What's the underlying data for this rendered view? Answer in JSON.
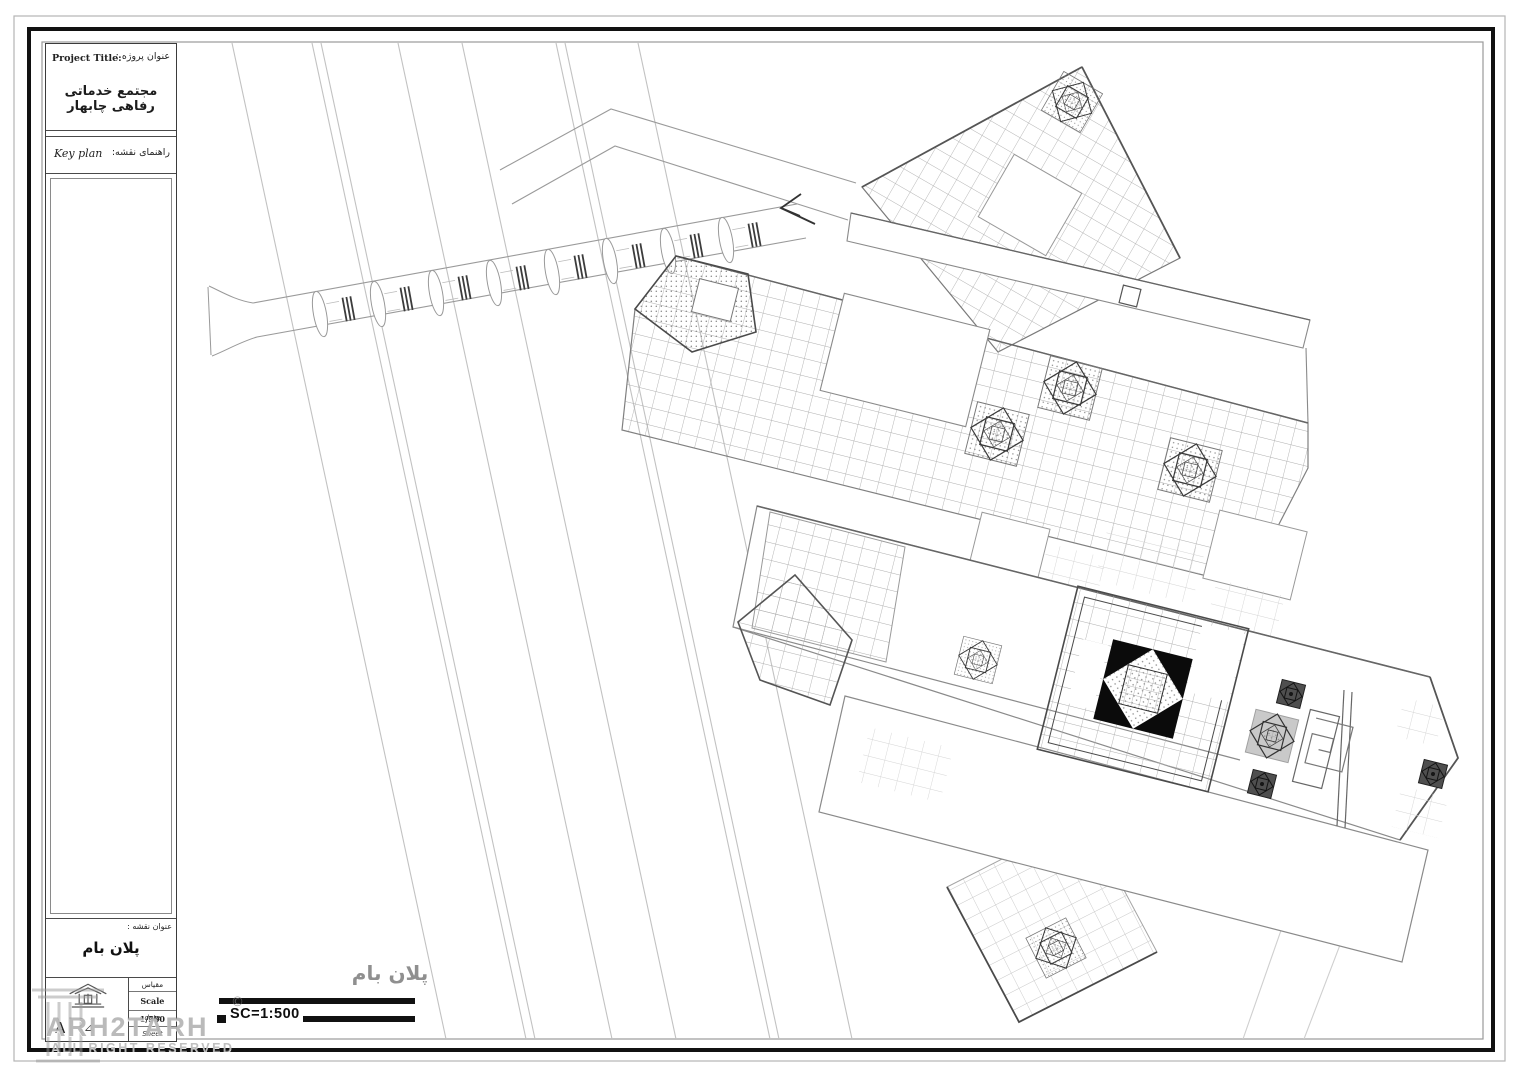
{
  "title_block": {
    "project_title_en": "Project Title:",
    "project_title_fa": "عنوان پروژه :",
    "project_name_fa": "مجتمع خدماتی رفاهی چابهار",
    "key_plan_en": "Key plan",
    "key_plan_fa": "راهنمای نقشه:",
    "sheet_title_label_fa": "عنوان نقشه :",
    "sheet_title_fa": "پلان بام",
    "scale_label_fa": "مقیاس",
    "scale_value": "Scale 1/500",
    "date_label": "date",
    "sheet_label": "Sheet",
    "revision_letter": "A",
    "triangle_glyph": "⊿"
  },
  "drawing": {
    "plan_label_fa": "پلان بام",
    "scale_bar_text": "SC=1:500"
  },
  "watermark": {
    "name": "ARH2TARH",
    "rights": "ALL RIGHT RESERVED",
    "copyright_symbol": "©"
  },
  "colors": {
    "paper": "#ffffff",
    "frame_black": "#111111",
    "line_light": "#c2c2c2",
    "line_mid": "#8a8a8a",
    "line_dark": "#4a4a4a",
    "dome_fill": "#0b0b0b",
    "gray_skylight": "#c9c9c9"
  }
}
